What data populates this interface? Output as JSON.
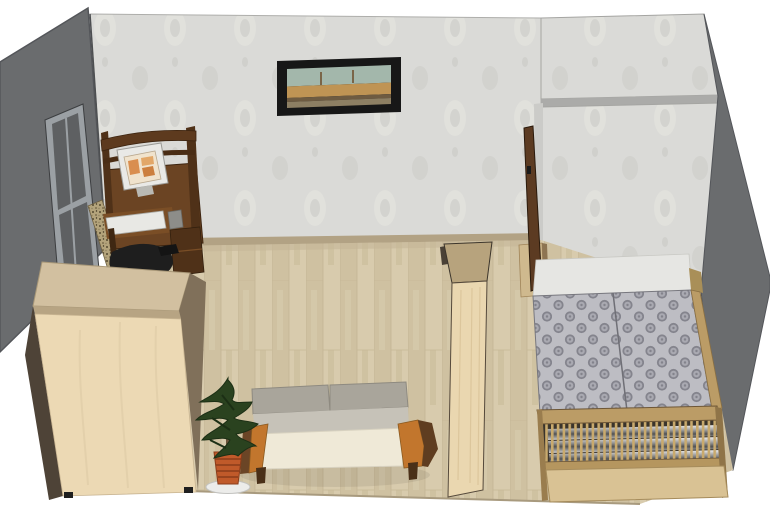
{
  "scene": {
    "title": "3D room interior render",
    "view": "isometric cutaway, top-front view",
    "objects": [
      {
        "id": "left-wall",
        "label": "left wall (cutaway, dark gray)"
      },
      {
        "id": "back-wall",
        "label": "back wall with damask wallpaper"
      },
      {
        "id": "window",
        "label": "window on left wall"
      },
      {
        "id": "painting",
        "label": "framed cityscape painting"
      },
      {
        "id": "computer-desk",
        "label": "dark wood computer desk with hutch, monitor and keyboard"
      },
      {
        "id": "office-chair",
        "label": "black office chair"
      },
      {
        "id": "rug",
        "label": "speckled runner rug along left wall"
      },
      {
        "id": "wardrobe",
        "label": "light beech wardrobe"
      },
      {
        "id": "sofa",
        "label": "sofa with gray cushions and orange wood arms"
      },
      {
        "id": "potted-plant",
        "label": "conifer plant in terracotta pot"
      },
      {
        "id": "divider-cabinet",
        "label": "tall narrow beech shelf divider"
      },
      {
        "id": "door",
        "label": "open dark brown door"
      },
      {
        "id": "dresser",
        "label": "low beech dresser beside door"
      },
      {
        "id": "partition-wall",
        "label": "wallpapered partition forming bed alcove"
      },
      {
        "id": "right-wall",
        "label": "right wall (cutaway, dark gray)"
      },
      {
        "id": "double-bed",
        "label": "double bed with patterned gray covers, slatted footboard and chrome radiator"
      },
      {
        "id": "floor",
        "label": "light laminate plank floor"
      }
    ]
  },
  "colors": {
    "background": "#ffffff",
    "wall_dark": "#6a6c6e",
    "wall_dark_edge": "#54565a",
    "wallpaper_base": "#dadad7",
    "wall_cap": "#ababa9",
    "wall_end_face": "#cbcbc8",
    "baseboard": "#b2a284",
    "floor_base": "#d4c7a9",
    "floor_edge": "#a89a7e",
    "window_frame": "#9ba0a4",
    "window_glass": "#5e6062",
    "painting_frame": "#171717",
    "painting_sky": "#a3b7ab",
    "painting_building": "#bf9454",
    "painting_arcade": "#6e5b41",
    "painting_ground": "#8d7f63",
    "desk_wood": "#6b4423",
    "desk_wood_dark": "#4f3118",
    "monitor_body": "#e9e9e6",
    "monitor_screen": "#f0e3cd",
    "screen_accent": "#d98e4f",
    "keyboard": "#e8e8e4",
    "speaker": "#8d8d89",
    "chair_black": "#1e1e1e",
    "rug_base": "#b3a37b",
    "wardrobe_front": "#ecd9b4",
    "wardrobe_top": "#d2c0a0",
    "wardrobe_bevel": "#b7a483",
    "wardrobe_side": "#80705a",
    "wardrobe_side_dark": "#4e4337",
    "sofa_cushion": "#a9a59b",
    "sofa_cushion_front": "#c6c2b8",
    "sofa_seat": "#efe9d7",
    "sofa_arm_orange": "#c2762d",
    "sofa_arm_dark": "#6b4526",
    "sofa_leg": "#4a3018",
    "plant_green": "#2a421f",
    "plant_green_dark": "#1c2f15",
    "plant_trunk": "#6b543a",
    "pot_terracotta": "#c05a2a",
    "pot_ring": "#8a3c1a",
    "saucer": "#ececea",
    "divider_front": "#ead7b0",
    "divider_top": "#b7a37d",
    "door_wood": "#5c3b22",
    "dresser_wood": "#cfb98e",
    "bedding_white": "#e6e6e3",
    "bed_cover_base": "#bdbdc3",
    "bed_cover_motif": "#84848d",
    "bed_wood": "#bb9c66",
    "bed_slat": "#c9aa6d",
    "bed_slat_bg": "#3a342c",
    "bed_base": "#d9c294"
  }
}
